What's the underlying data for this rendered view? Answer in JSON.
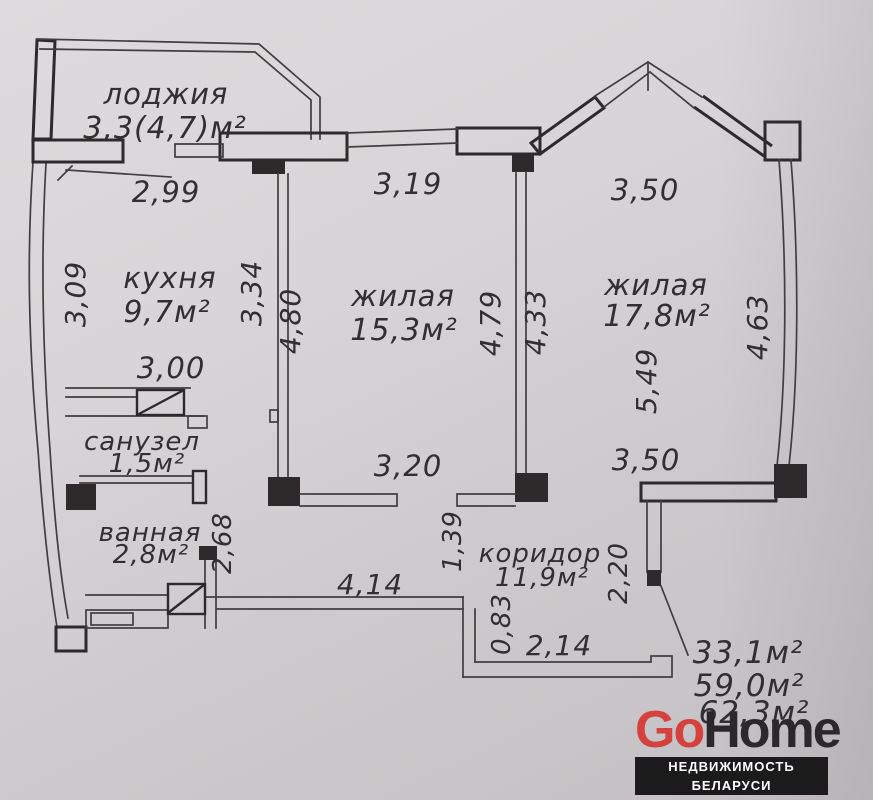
{
  "plan": {
    "rooms": [
      {
        "name": "лоджия",
        "area": "3,3(4,7)м²"
      },
      {
        "name": "кухня",
        "area": "9,7м²"
      },
      {
        "name": "жилая",
        "area": "15,3м²"
      },
      {
        "name": "жилая",
        "area": "17,8м²"
      },
      {
        "name": "санузел",
        "area": "1,5м²"
      },
      {
        "name": "ванная",
        "area": "2,8м²"
      },
      {
        "name": "коридор",
        "area": "11,9м²"
      }
    ],
    "dims": {
      "kitchen_top": "2,99",
      "room1_top": "3,19",
      "room2_top": "3,50",
      "kitchen_left": "3,09",
      "kitchen_right": "3,34",
      "room1_left": "4,80",
      "room1_right": "4,79",
      "room2_left": "4,33",
      "room2_right": "4,63",
      "room2_mid": "5,49",
      "kitchen_bottom": "3,00",
      "room1_bottom": "3,20",
      "room2_bottom": "3,50",
      "bath_right": "2,68",
      "corridor_near_room1": "1,39",
      "entry_right": "2,20",
      "corridor_bottom": "4,14",
      "corridor_step": "0,83",
      "entry_bottom": "2,14"
    },
    "totals": {
      "living": "33,1м²",
      "total": "59,0м²",
      "total_with_loggia": "62,3м²"
    }
  },
  "logo": {
    "brand_go": "Go",
    "brand_home": "Home",
    "tagline": "НЕДВИЖИМОСТЬ БЕЛАРУСИ"
  },
  "colors": {
    "accent_red": "#d5413c",
    "logo_dark": "#2a282b",
    "line": "#2d2a2c",
    "paper": "#d6d2d5"
  }
}
